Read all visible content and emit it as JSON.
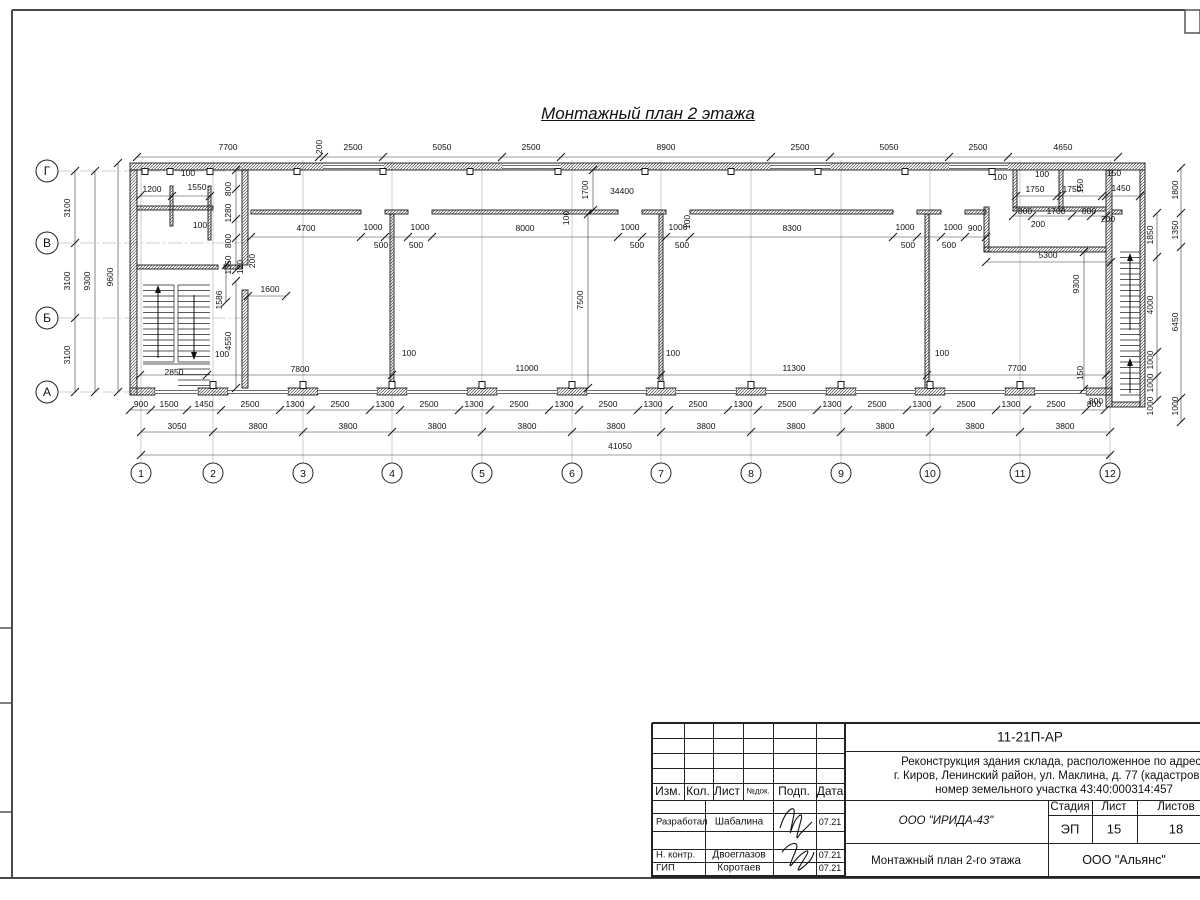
{
  "sheet": {
    "title": "Монтажный план 2 этажа"
  },
  "plan": {
    "column_axes": [
      {
        "label": "1",
        "x": 141
      },
      {
        "label": "2",
        "x": 213
      },
      {
        "label": "3",
        "x": 303
      },
      {
        "label": "4",
        "x": 392
      },
      {
        "label": "5",
        "x": 482
      },
      {
        "label": "6",
        "x": 572
      },
      {
        "label": "7",
        "x": 661
      },
      {
        "label": "8",
        "x": 751
      },
      {
        "label": "9",
        "x": 841
      },
      {
        "label": "10",
        "x": 930
      },
      {
        "label": "11",
        "x": 1020
      },
      {
        "label": "12",
        "x": 1110
      }
    ],
    "row_axes": [
      {
        "label": "Г",
        "y": 171
      },
      {
        "label": "В",
        "y": 243
      },
      {
        "label": "Б",
        "y": 318
      },
      {
        "label": "А",
        "y": 392
      }
    ],
    "dims": [
      [
        "7700",
        228,
        150
      ],
      [
        "200",
        322,
        147,
        1
      ],
      [
        "2500",
        353,
        150
      ],
      [
        "5050",
        442,
        150
      ],
      [
        "2500",
        531,
        150
      ],
      [
        "8900",
        666,
        150
      ],
      [
        "2500",
        800,
        150
      ],
      [
        "5050",
        889,
        150
      ],
      [
        "2500",
        978,
        150
      ],
      [
        "4650",
        1063,
        150
      ],
      [
        "3100",
        70,
        208,
        1
      ],
      [
        "3100",
        70,
        281,
        1
      ],
      [
        "3100",
        70,
        355,
        1
      ],
      [
        "9300",
        90,
        281,
        1
      ],
      [
        "9600",
        113,
        277,
        1
      ],
      [
        "100",
        188,
        176
      ],
      [
        "1200",
        152,
        192
      ],
      [
        "1550",
        197,
        190
      ],
      [
        "100",
        200,
        228
      ],
      [
        "800",
        231,
        189,
        1
      ],
      [
        "1280",
        231,
        213,
        1
      ],
      [
        "800",
        231,
        241,
        1
      ],
      [
        "1350",
        231,
        265,
        1
      ],
      [
        "120",
        243,
        267,
        1
      ],
      [
        "200",
        255,
        261,
        1
      ],
      [
        "1586",
        222,
        300,
        1
      ],
      [
        "1600",
        270,
        292
      ],
      [
        "4550",
        231,
        341,
        1
      ],
      [
        "100",
        222,
        357
      ],
      [
        "2850",
        174,
        375
      ],
      [
        "4700",
        306,
        231
      ],
      [
        "1000",
        373,
        230
      ],
      [
        "500",
        381,
        248
      ],
      [
        "1000",
        420,
        230
      ],
      [
        "500",
        416,
        248
      ],
      [
        "8000",
        525,
        231
      ],
      [
        "1000",
        630,
        230
      ],
      [
        "500",
        637,
        248
      ],
      [
        "1000",
        678,
        230
      ],
      [
        "500",
        682,
        248
      ],
      [
        "8300",
        792,
        231
      ],
      [
        "1000",
        905,
        230
      ],
      [
        "500",
        908,
        248
      ],
      [
        "1000",
        953,
        230
      ],
      [
        "500",
        949,
        248
      ],
      [
        "900",
        975,
        231
      ],
      [
        "7500",
        583,
        300,
        1
      ],
      [
        "100",
        569,
        218,
        1
      ],
      [
        "100",
        690,
        222,
        1
      ],
      [
        "1700",
        588,
        190,
        1
      ],
      [
        "34400",
        622,
        194
      ],
      [
        "5300",
        1048,
        258
      ],
      [
        "9300",
        1079,
        284,
        1
      ],
      [
        "200",
        1038,
        227
      ],
      [
        "200",
        1108,
        222
      ],
      [
        "100",
        1000,
        180
      ],
      [
        "100",
        1042,
        177
      ],
      [
        "1750",
        1035,
        192
      ],
      [
        "1750",
        1072,
        192
      ],
      [
        "150",
        1083,
        186,
        1
      ],
      [
        "150",
        1114,
        176
      ],
      [
        "1450",
        1121,
        191
      ],
      [
        "800",
        1025,
        214
      ],
      [
        "1700",
        1056,
        214
      ],
      [
        "800",
        1089,
        214
      ],
      [
        "1800",
        1178,
        190,
        1
      ],
      [
        "1850",
        1153,
        235,
        1
      ],
      [
        "1350",
        1178,
        230,
        1
      ],
      [
        "4000",
        1153,
        305,
        1
      ],
      [
        "6450",
        1178,
        322,
        1
      ],
      [
        "1000",
        1153,
        360,
        1
      ],
      [
        "1000",
        1153,
        383,
        1
      ],
      [
        "1000",
        1153,
        406,
        1
      ],
      [
        "1000",
        1178,
        406,
        1
      ],
      [
        "150",
        1083,
        373,
        1
      ],
      [
        "800",
        1096,
        404
      ],
      [
        "7800",
        300,
        372
      ],
      [
        "11000",
        527,
        371
      ],
      [
        "11300",
        794,
        371
      ],
      [
        "7700",
        1017,
        371
      ],
      [
        "100",
        409,
        356
      ],
      [
        "100",
        673,
        356
      ],
      [
        "100",
        942,
        356
      ],
      [
        "900",
        141,
        407
      ],
      [
        "1500",
        169,
        407
      ],
      [
        "1450",
        204,
        407
      ],
      [
        "2500",
        250,
        407
      ],
      [
        "1300",
        295,
        407
      ],
      [
        "2500",
        340,
        407
      ],
      [
        "1300",
        385,
        407
      ],
      [
        "2500",
        429,
        407
      ],
      [
        "1300",
        474,
        407
      ],
      [
        "2500",
        519,
        407
      ],
      [
        "1300",
        564,
        407
      ],
      [
        "2500",
        608,
        407
      ],
      [
        "1300",
        653,
        407
      ],
      [
        "2500",
        698,
        407
      ],
      [
        "1300",
        743,
        407
      ],
      [
        "2500",
        787,
        407
      ],
      [
        "1300",
        832,
        407
      ],
      [
        "2500",
        877,
        407
      ],
      [
        "1300",
        922,
        407
      ],
      [
        "2500",
        966,
        407
      ],
      [
        "1300",
        1011,
        407
      ],
      [
        "2500",
        1056,
        407
      ],
      [
        "800",
        1094,
        407
      ],
      [
        "3050",
        177,
        429
      ],
      [
        "3800",
        258,
        429
      ],
      [
        "3800",
        348,
        429
      ],
      [
        "3800",
        437,
        429
      ],
      [
        "3800",
        527,
        429
      ],
      [
        "3800",
        616,
        429
      ],
      [
        "3800",
        706,
        429
      ],
      [
        "3800",
        796,
        429
      ],
      [
        "3800",
        885,
        429
      ],
      [
        "3800",
        975,
        429
      ],
      [
        "3800",
        1065,
        429
      ],
      [
        "41050",
        620,
        449
      ]
    ]
  },
  "titleblock": {
    "doc_code": "11-21П-АР",
    "project_lines": [
      "Реконструкция здания склада, расположенное по адресу",
      "г. Киров, Ленинский район, ул. Маклина, д. 77 (кадастровый",
      "номер земельного участка 43:40:000314:457"
    ],
    "org": "ООО \"ИРИДА-43\"",
    "sheet_name": "Монтажный план 2-го этажа",
    "contractor": "ООО \"Альянс\"",
    "header_cols": [
      "Изм.",
      "Кол.",
      "Лист",
      "№док.",
      "Подп.",
      "Дата"
    ],
    "stage_header": [
      "Стадия",
      "Лист",
      "Листов"
    ],
    "stage_values": [
      "ЭП",
      "15",
      "18"
    ],
    "people": [
      {
        "role": "Разработал",
        "name": "Шабалина",
        "date": "07.21"
      },
      {
        "role": "Н. контр.",
        "name": "Двоеглазов",
        "date": "07.21"
      },
      {
        "role": "ГИП",
        "name": "Коротаев",
        "date": "07.21"
      }
    ]
  }
}
